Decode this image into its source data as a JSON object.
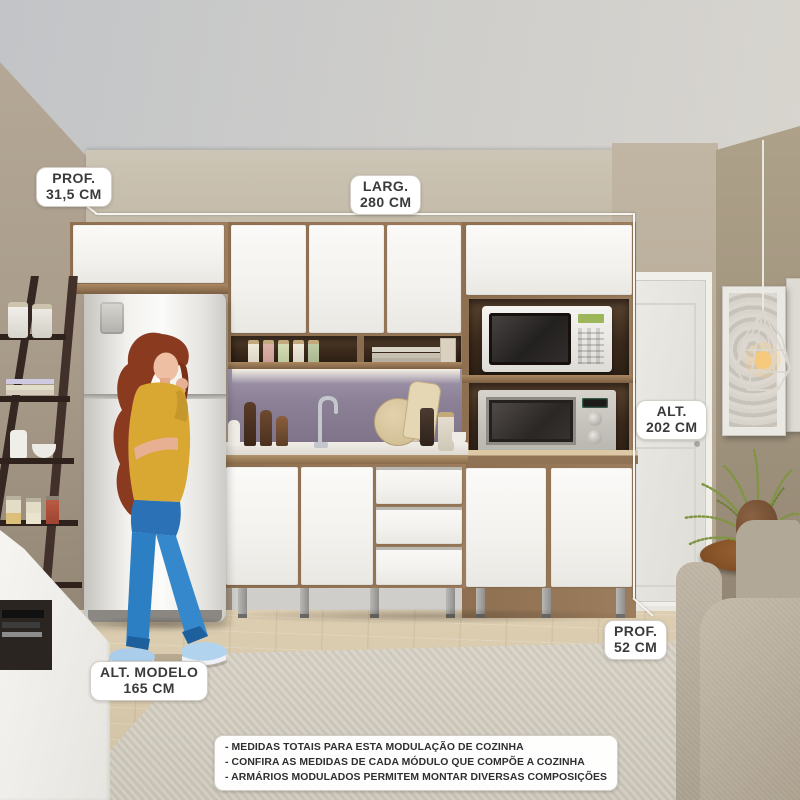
{
  "measurements": {
    "depth_top": {
      "title": "PROF.",
      "value": "31,5 CM"
    },
    "width": {
      "title": "LARG.",
      "value": "280 CM"
    },
    "height": {
      "title": "ALT.",
      "value": "202 CM"
    },
    "depth_bottom": {
      "title": "PROF.",
      "value": "52 CM"
    },
    "model_height": {
      "title": "ALT. MODELO",
      "value": "165 CM"
    }
  },
  "notes": {
    "lines": [
      "- MEDIDAS TOTAIS PARA ESTA MODULAÇÃO DE COZINHA",
      "- CONFIRA AS MEDIDAS DE CADA MÓDULO QUE COMPÕE A COZINHA",
      "- ARMÁRIOS MODULADOS PERMITEM MONTAR DIVERSAS COMPOSIÇÕES"
    ]
  },
  "colors": {
    "backsplash_purple": "#8b8096",
    "cabinet_wood": "#9b7c5c",
    "cabinet_white": "#f6f5f2",
    "wall_taupe": "#b3a694",
    "shirt_yellow": "#d9a833",
    "jeans_blue": "#2d7fc4",
    "label_text": "#3a3a3a"
  }
}
